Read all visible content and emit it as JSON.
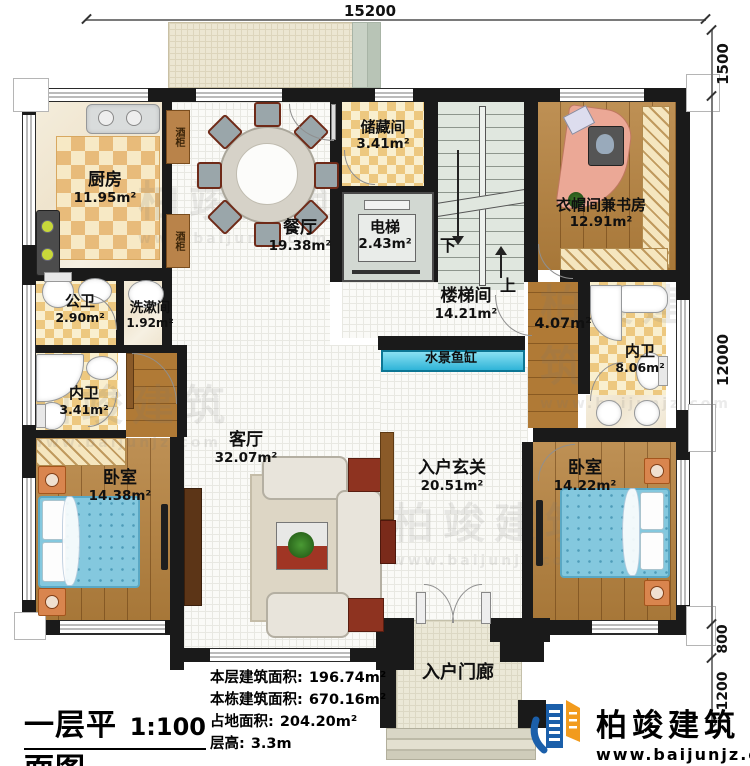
{
  "dimensions": {
    "top": "15200",
    "right_terrace": "1500",
    "right_main": "12000",
    "right_porch_a": "800",
    "right_porch_b": "1200"
  },
  "rooms": {
    "kitchen": {
      "name": "厨房",
      "area": "11.95m²"
    },
    "dining": {
      "name": "餐厅",
      "area": "19.38m²"
    },
    "storage": {
      "name": "储藏间",
      "area": "3.41m²"
    },
    "elevator": {
      "name": "电梯",
      "area": "2.43m²"
    },
    "cloakroom_study": {
      "name": "衣帽间兼书房",
      "area": "12.91m²"
    },
    "stair_hall": {
      "name": "楼梯间",
      "area": "14.21m²"
    },
    "corridor": {
      "area": "4.07m²"
    },
    "public_bath": {
      "name": "公卫",
      "area": "2.90m²"
    },
    "washroom": {
      "name": "洗漱间",
      "area": "1.92m²"
    },
    "ensuite_left": {
      "name": "内卫",
      "area": "3.41m²"
    },
    "ensuite_right": {
      "name": "内卫",
      "area": "8.06m²"
    },
    "bedroom_left": {
      "name": "卧室",
      "area": "14.38m²"
    },
    "bedroom_right": {
      "name": "卧室",
      "area": "14.22m²"
    },
    "living": {
      "name": "客厅",
      "area": "32.07m²"
    },
    "foyer": {
      "name": "入户玄关",
      "area": "20.51m²"
    },
    "porch": {
      "name": "入户门廊"
    },
    "water_feature": {
      "name": "水景鱼缸"
    }
  },
  "fixtures": {
    "wine_cabinet": "酒柜",
    "stairs_down": "下",
    "stairs_up": "上"
  },
  "title_block": {
    "title": "一层平面图",
    "scale": "1:100",
    "stats": [
      {
        "label": "本层建筑面积:",
        "value": "196.74m²"
      },
      {
        "label": "本栋建筑面积:",
        "value": "670.16m²"
      },
      {
        "label": "占地面积:",
        "value": "204.20m²"
      },
      {
        "label": "层高:",
        "value": "3.3m"
      }
    ]
  },
  "branding": {
    "name": "柏竣建筑",
    "website": "www.baijunjz.com"
  },
  "colors": {
    "wall": "#1a1a1a",
    "water": "#43c5e4",
    "wood": "#b5813d",
    "accent_blue": "#1b5faa",
    "accent_orange": "#f29b1d"
  }
}
